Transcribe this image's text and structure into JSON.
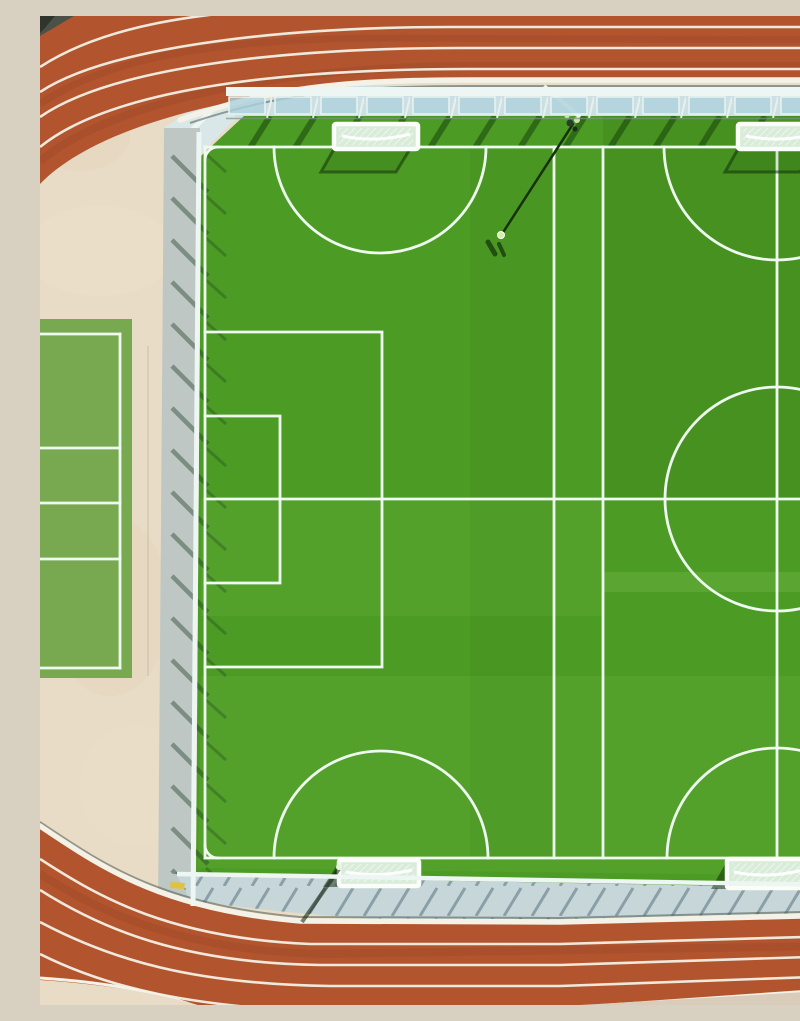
{
  "scene": {
    "type": "aerial-photograph",
    "description": "Top-down drone view of a sports complex: a terracotta running track with white lane lines curving around a bright green artificial-turf football area divided into two small pitches with four white goals, overlapping penalty-box and centre-circle markings, a floodlight pole casting a long diagonal shadow, light blue walkways with wind-screen fencing casting diagonal shadows, and a light green volleyball court on the left over a beige concrete apron."
  },
  "colors": {
    "beige": "#e9dcc6",
    "beige_dark": "#d9ccba",
    "track_orange": "#b2552f",
    "track_streak": "#8f3c1e",
    "lane_white": "#efe9dc",
    "curb_white": "#f4f1e7",
    "walk_blue": "#ccdfe3",
    "walk_blue2": "#c6d6d9",
    "walk_gray": "#bec7c4",
    "wedge": "#d9e7e9",
    "fence_white": "#edf6f2",
    "panel_blue": "#aed2dc",
    "walk_shadow": "#8aa0a6",
    "field_green": "#4c9b24",
    "line_white": "#eefaef",
    "shadow_green": "rgba(18,58,8,0.5)",
    "court_green": "#78a950",
    "goal_white": "#fafdf8",
    "goal_inner": "#d9ecd9",
    "pole_dark": "#16320c",
    "yellow_mark": "#e0c23c",
    "dark_roof": "#4c5148",
    "dark_roof2": "#2f342c"
  },
  "features": {
    "running_track": {
      "surface": "rubber",
      "color_name": "terracotta",
      "visible_lane_lines_top": 4,
      "visible_lane_lines_bottom": 4,
      "lane_line_color": "white",
      "layout": "curves around top-left and bottom-left corners"
    },
    "football_area": {
      "pitches": 2,
      "goals": 4,
      "markings": [
        "outer boundary",
        "halfway line",
        "penalty area",
        "goal area",
        "centre circle",
        "goal semicircle arcs",
        "corner arcs",
        "three vertical divider lines"
      ]
    },
    "volleyball_court": {
      "position": "left edge",
      "lines": [
        "end line",
        "attack line",
        "centre line",
        "attack line",
        "end line",
        "sideline"
      ]
    },
    "floodlight_pole": {
      "position": "top centre fence",
      "shadow_direction": "down-left"
    },
    "fencing": {
      "type": "windscreen panels on railing",
      "shadow_pattern": "diagonal stripes"
    },
    "walkways": {
      "color_name": "light blue-grey concrete"
    }
  }
}
